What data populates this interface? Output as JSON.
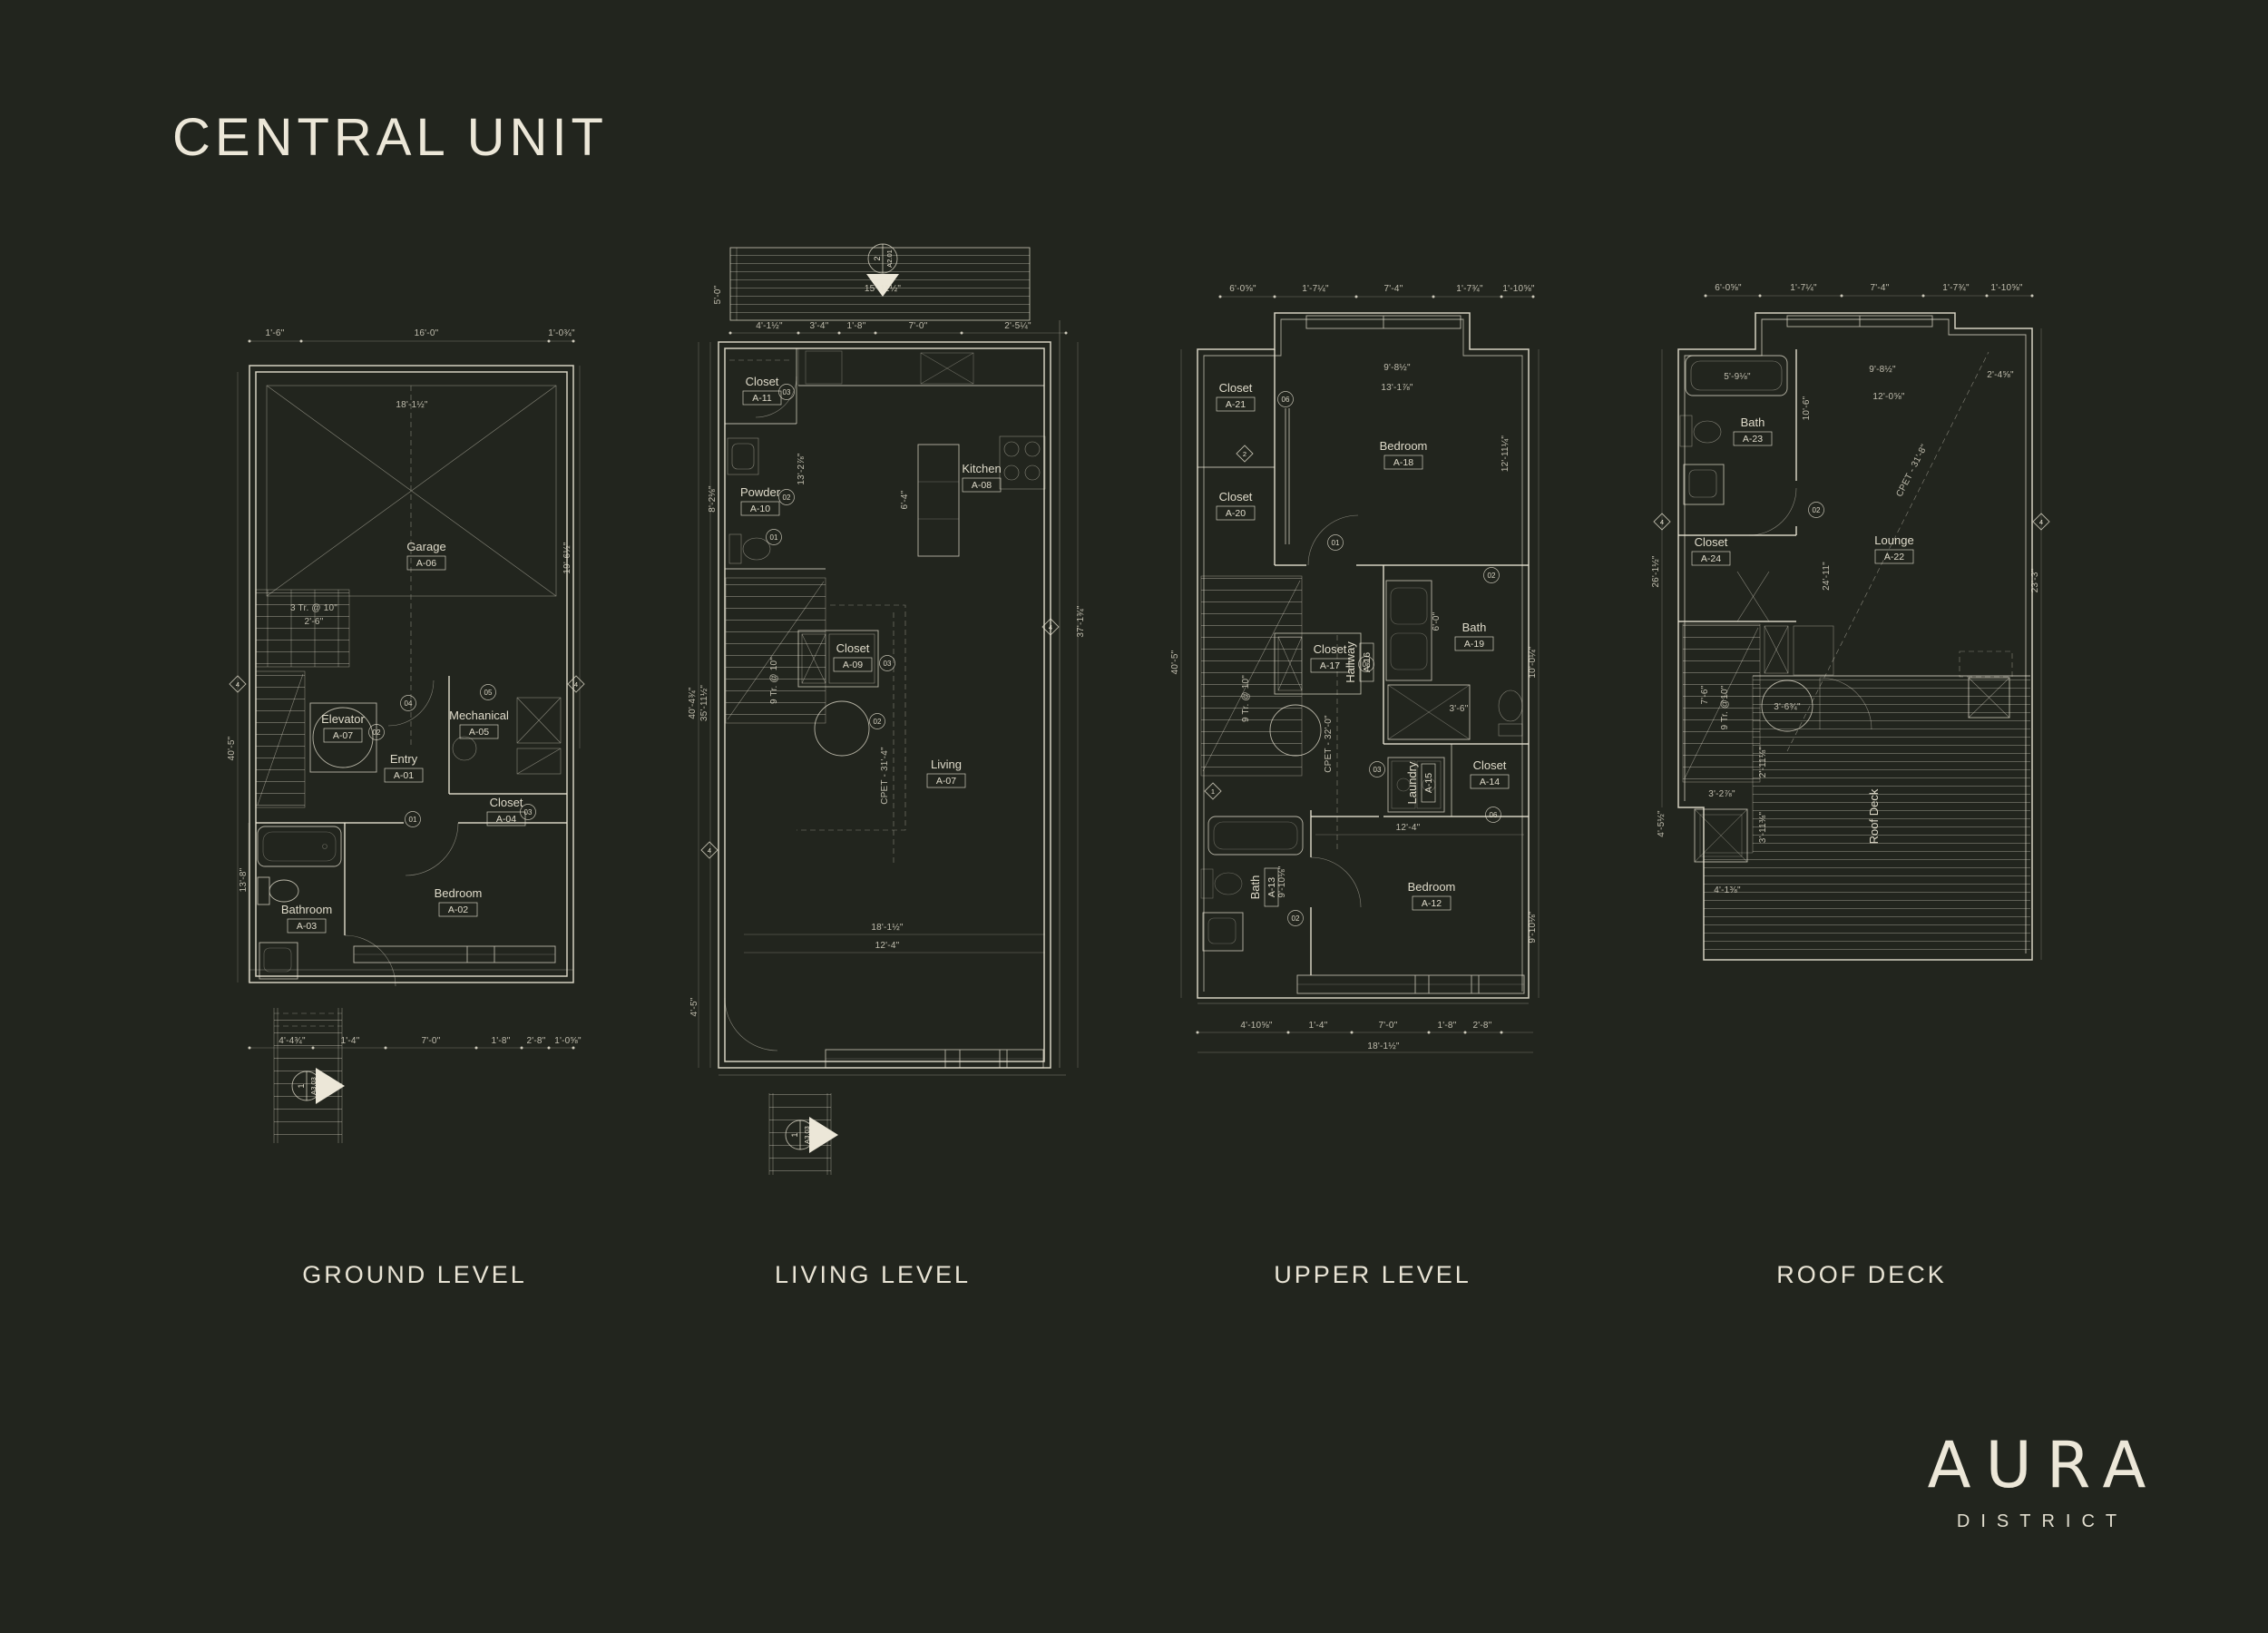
{
  "title": "CENTRAL UNIT",
  "logo": {
    "brand": "AURA",
    "sub": "DISTRICT"
  },
  "plans": [
    {
      "label": "GROUND LEVEL",
      "rooms": [
        {
          "name": "Garage",
          "code": "A-06"
        },
        {
          "name": "Elevator",
          "code": "A-07"
        },
        {
          "name": "Entry",
          "code": "A-01"
        },
        {
          "name": "Mechanical",
          "code": "A-05"
        },
        {
          "name": "Closet",
          "code": "A-04"
        },
        {
          "name": "Bathroom",
          "code": "A-03"
        },
        {
          "name": "Bedroom",
          "code": "A-02"
        }
      ],
      "dims": {
        "top": [
          "1'-6\"",
          "16'-0\"",
          "1'-0¾\""
        ],
        "left": [
          "40'-5\"",
          "13'-8\""
        ],
        "right": [
          "19'-6½\""
        ],
        "interior": [
          "18'-1½\"",
          "3 Tr. @ 10\"",
          "2'-6\""
        ],
        "bottom": [
          "4'-4¾\"",
          "1'-4\"",
          "7'-0\"",
          "1'-8\"",
          "2'-8\"",
          "1'-0⅝\""
        ]
      },
      "tags": [
        "01",
        "02",
        "03",
        "04",
        "05"
      ],
      "diamonds": [
        "4",
        "4"
      ],
      "marker": {
        "num": "1",
        "sheet": "A3.03"
      }
    },
    {
      "label": "LIVING LEVEL",
      "rooms": [
        {
          "name": "Closet",
          "code": "A-11"
        },
        {
          "name": "Powder",
          "code": "A-10"
        },
        {
          "name": "Kitchen",
          "code": "A-08"
        },
        {
          "name": "Closet",
          "code": "A-09"
        },
        {
          "name": "Living",
          "code": "A-07"
        }
      ],
      "dims": {
        "top": [
          "15'-11½\"",
          "5'-0\""
        ],
        "band": [
          "4'-1½\"",
          "3'-4\"",
          "1'-8\"",
          "7'-0\"",
          "2'-5¼\""
        ],
        "left": [
          "40'-4¾\"",
          "35'-11½\"",
          "8'-2⅛\"",
          "4'-5\""
        ],
        "right": [
          "37'-1¾\""
        ],
        "interior": [
          "CPET - 31'-4\"",
          "9 Tr. @ 10\"",
          "6'-4\"",
          "13'-2⅞\"",
          "18'-1½\"",
          "12'-4\""
        ]
      },
      "tags": [
        "01",
        "02",
        "03"
      ],
      "diamonds": [
        "4",
        "4"
      ],
      "marker": {
        "num": "1",
        "sheet": "A3.03"
      },
      "section": {
        "num": "2",
        "sheet": "A2.01"
      }
    },
    {
      "label": "UPPER LEVEL",
      "rooms": [
        {
          "name": "Closet",
          "code": "A-21"
        },
        {
          "name": "Closet",
          "code": "A-20"
        },
        {
          "name": "Bedroom",
          "code": "A-18"
        },
        {
          "name": "Closet",
          "code": "A-17"
        },
        {
          "name": "Hallway",
          "code": "A-16"
        },
        {
          "name": "Bath",
          "code": "A-19"
        },
        {
          "name": "Laundry",
          "code": "A-15"
        },
        {
          "name": "Closet",
          "code": "A-14"
        },
        {
          "name": "Bath",
          "code": "A-13"
        },
        {
          "name": "Bedroom",
          "code": "A-12"
        }
      ],
      "dims": {
        "top": [
          "6'-0⅝\"",
          "1'-7¼\"",
          "7'-4\"",
          "1'-7¾\"",
          "1'-10⅝\""
        ],
        "left": [
          "40'-5\""
        ],
        "right": [
          "12'-11¼\"",
          "10'-0¼\"",
          "9'-10⅛\""
        ],
        "interior": [
          "13'-1⅞\"",
          "9'-8½\"",
          "CPET - 32'-0\"",
          "9 Tr. @ 10\"",
          "6'-0\"",
          "12'-4\"",
          "3'-6\""
        ],
        "bottom": [
          "4'-10⅝\"",
          "1'-4\"",
          "7'-0\"",
          "1'-8\"",
          "2'-8\"",
          "18'-1½\""
        ]
      },
      "tags": [
        "01",
        "02",
        "03",
        "06"
      ],
      "diamonds": [
        "2",
        "1"
      ]
    },
    {
      "label": "ROOF DECK",
      "rooms": [
        {
          "name": "Bath",
          "code": "A-23"
        },
        {
          "name": "Closet",
          "code": "A-24"
        },
        {
          "name": "Lounge",
          "code": "A-22"
        }
      ],
      "deck_label": "Roof Deck",
      "dims": {
        "top": [
          "6'-0⅝\"",
          "1'-7¼\"",
          "7'-4\"",
          "1'-7¾\"",
          "1'-10⅝\""
        ],
        "left": [
          "26'-1½\"",
          "4'-5½\""
        ],
        "right": [
          "23'-3\"",
          "2'-4⅝\""
        ],
        "interior": [
          "5'-9⅛\"",
          "10'-6\"",
          "9'-8½\"",
          "12'-0⅝\"",
          "CPET - 31'-8\"",
          "24'-11\"",
          "9 Tr. @10\"",
          "7'-6\"",
          "3'-6¾\"",
          "4'-1⅜\"",
          "3'-2⅞\"",
          "2'-11⅛\"",
          "3'-11⅜\""
        ]
      },
      "tags": [
        "02"
      ],
      "diamonds": [
        "4",
        "4"
      ]
    }
  ]
}
